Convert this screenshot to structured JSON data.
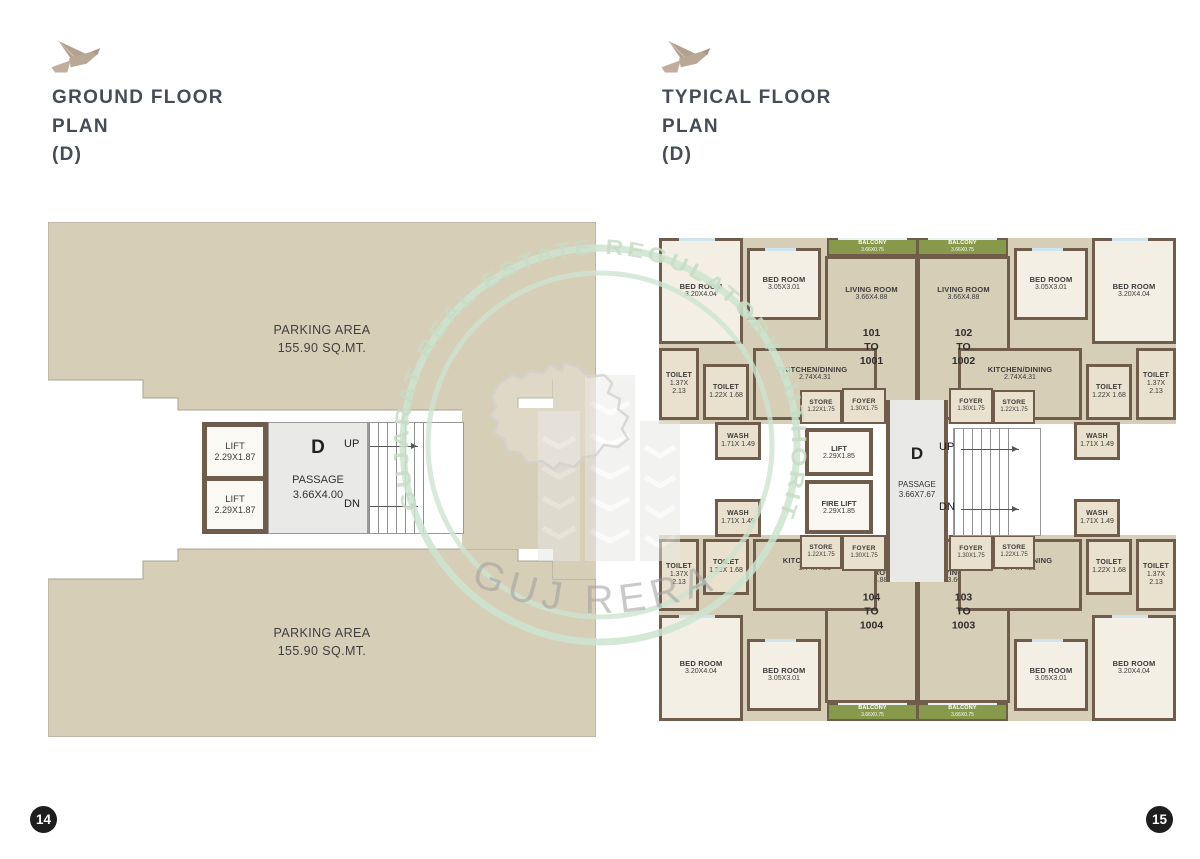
{
  "titles": {
    "left_line1": "GROUND FLOOR",
    "left_line2": "PLAN",
    "left_line3": "(D)",
    "right_line1": "TYPICAL FLOOR",
    "right_line2": "PLAN",
    "right_line3": "(D)"
  },
  "page_numbers": {
    "left": "14",
    "right": "15"
  },
  "watermark": {
    "arc_text": "GUJARAT REAL ESTATE REGULATORY AUTHORITY",
    "bottom_text": "GUJ RERA"
  },
  "colors": {
    "tan": "#d7ceb8",
    "cream": "#f3efe5",
    "light_tan": "#e9e1cd",
    "wall_brown": "#6f5c4a",
    "balcony_green": "#87994a",
    "passage_gray": "#e9e9e7",
    "title_text": "#454c57",
    "bird_logo": "#b3a08f",
    "watermark_green": "#cde4cf",
    "page_number_bg": "#1e1e1e"
  },
  "left_plan": {
    "parking_top_label": "PARKING AREA",
    "parking_top_area": "155.90 SQ.MT.",
    "parking_bottom_label": "PARKING AREA",
    "parking_bottom_area": "155.90 SQ.MT.",
    "lift1_label": "LIFT",
    "lift1_dim": "2.29X1.87",
    "lift2_label": "LIFT",
    "lift2_dim": "2.29X1.87",
    "block_letter": "D",
    "passage_label": "PASSAGE",
    "passage_dim": "3.66X4.00",
    "up": "UP",
    "dn": "DN"
  },
  "right_plan": {
    "block_letter": "D",
    "passage_label": "PASSAGE",
    "passage_dim": "3.66X7.67",
    "lift_label": "LIFT",
    "lift_dim": "2.29X1.85",
    "fire_lift_label": "FIRE LIFT",
    "fire_lift_dim": "2.29X1.85",
    "up": "UP",
    "dn": "DN",
    "units": [
      {
        "pos": "tl",
        "lines": [
          "101",
          "TO",
          "1001"
        ]
      },
      {
        "pos": "tr",
        "lines": [
          "102",
          "TO",
          "1002"
        ]
      },
      {
        "pos": "bl",
        "lines": [
          "104",
          "TO",
          "1004"
        ]
      },
      {
        "pos": "br",
        "lines": [
          "103",
          "TO",
          "1003"
        ]
      }
    ],
    "rooms": [
      {
        "key": "bedroom-large",
        "label": "BED ROOM",
        "dim": "3.20X4.04",
        "type": "cream",
        "x": 4,
        "y": 16,
        "w": 84,
        "h": 106
      },
      {
        "key": "bedroom-small",
        "label": "BED ROOM",
        "dim": "3.05X3.01",
        "type": "cream",
        "x": 92,
        "y": 26,
        "w": 74,
        "h": 72
      },
      {
        "key": "living-room",
        "label": "LIVING ROOM",
        "dim": "3.66X4.88",
        "type": "tan living",
        "x": 170,
        "y": 34,
        "w": 93,
        "h": 164
      },
      {
        "key": "balcony",
        "label": "BALCONY",
        "dim": "3.66X0.75",
        "type": "balcony",
        "x": 172,
        "y": 16,
        "w": 91,
        "h": 18
      },
      {
        "key": "toilet-1",
        "label": "TOILET",
        "dim": "1.37X 2.13",
        "type": "lt narrow",
        "x": 4,
        "y": 126,
        "w": 40,
        "h": 72
      },
      {
        "key": "toilet-2",
        "label": "TOILET",
        "dim": "1.22X 1.68",
        "type": "lt narrow",
        "x": 48,
        "y": 142,
        "w": 46,
        "h": 56
      },
      {
        "key": "wash",
        "label": "WASH",
        "dim": "1.71X 1.49",
        "type": "lt narrow",
        "x": 60,
        "y": 200,
        "w": 46,
        "h": 38
      },
      {
        "key": "kitchen",
        "label": "KITCHEN/DINING",
        "dim": "2.74X4.31",
        "type": "tan kitchen",
        "x": 98,
        "y": 126,
        "w": 124,
        "h": 72
      },
      {
        "key": "store",
        "label": "STORE",
        "dim": "1.22X1.75",
        "type": "lt tiny",
        "x": 145,
        "y": 168,
        "w": 42,
        "h": 34
      },
      {
        "key": "foyer",
        "label": "FOYER",
        "dim": "1.30X1.75",
        "type": "lt tiny",
        "x": 187,
        "y": 166,
        "w": 44,
        "h": 36
      }
    ]
  }
}
